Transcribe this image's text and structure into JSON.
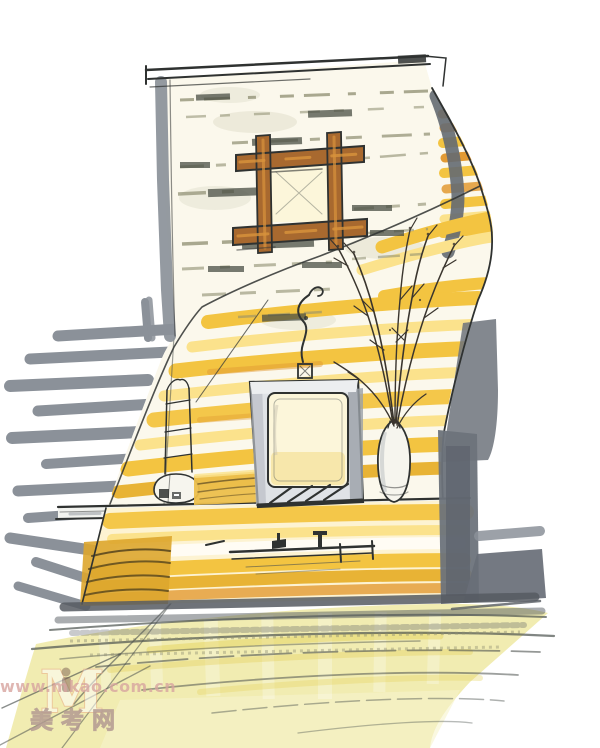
{
  "artwork": {
    "watermark": {
      "logo_letter": "M",
      "url_text": "www.mkao.com.cn",
      "site_name": "美考网"
    }
  },
  "palette": {
    "paper": "#ffffff",
    "wall_white": "#fbf8ec",
    "marker_yellow": "#f3c441",
    "yellow_light": "#fbe28c",
    "yellow_deep": "#e8b335",
    "marker_orange": "#e29a33",
    "ochre_dark": "#dda62e",
    "floor_yellow": "#f0eaaa",
    "floor_light": "#f7f3cc",
    "floor_accent": "#e5d35e",
    "marker_gray": "#8b9199",
    "gray_dark": "#646a72",
    "gray_band": "#6d737b",
    "shadow_dark": "#565b61",
    "ink": "#2f3231",
    "ink_soft": "#4c524e",
    "olive": "#8d8d70",
    "smudge": "#4a4f45",
    "wash": "#b9b99a",
    "wood_brown": "#a8692f",
    "wood_orange": "#d8933c",
    "cabinet_cream": "#fdf3d2",
    "frame_gray": "#dfe2e6",
    "glass_cream": "#fcf6da",
    "glass_tint": "#f5e19b",
    "stack_yellow": "#ecbf4c",
    "stack_line": "#6a5526",
    "curve_line": "#54431d",
    "vase_white": "#f6f5ee",
    "wm_pink": "#d8a5a0",
    "wm_gray": "#b39a92",
    "wm_fill": "#e8dfda",
    "wm_orange": "#e9ab88",
    "wm_figure": "#7a5c52"
  }
}
